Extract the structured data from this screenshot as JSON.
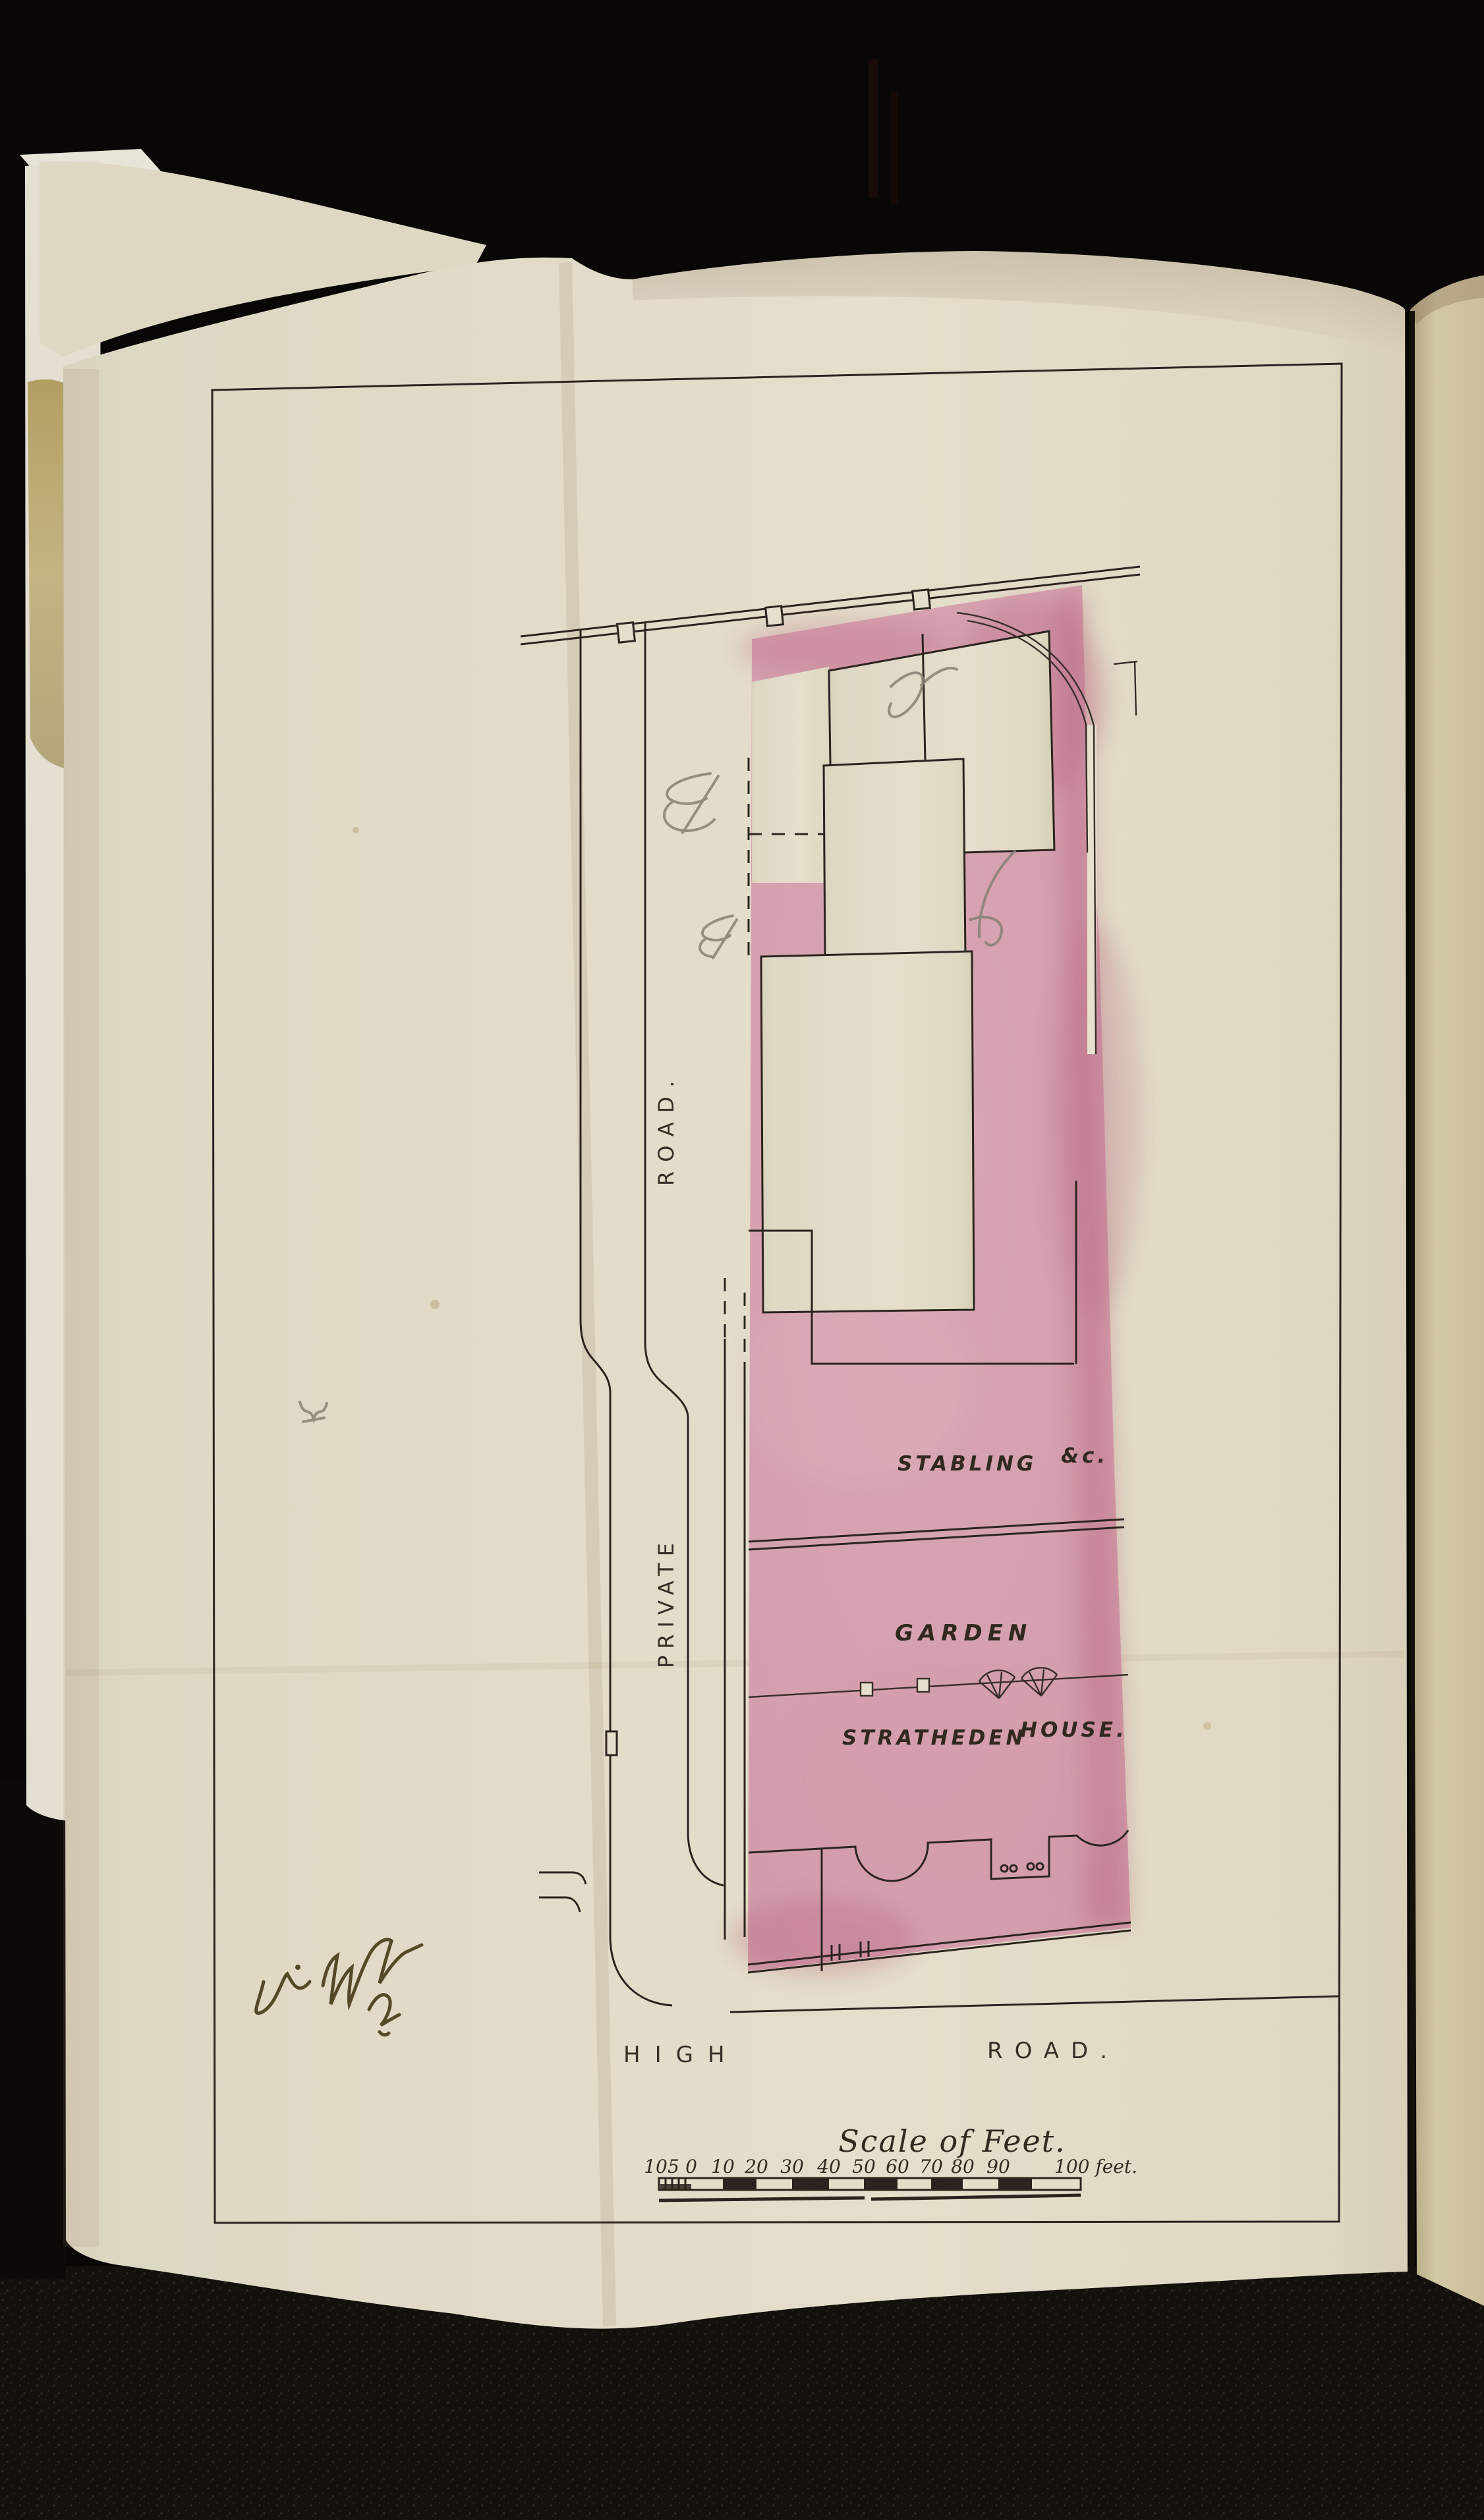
{
  "plan": {
    "labels": {
      "stabling": {
        "name": "STABLING",
        "suffix": "&c."
      },
      "garden": "GARDEN",
      "house": {
        "name": "STRATHEDEN",
        "suffix": "HOUSE."
      },
      "private_road_vertical": {
        "upper": "ROAD.",
        "lower": "PRIVATE"
      },
      "high_road": {
        "left": "HIGH",
        "right": "ROAD."
      }
    },
    "scale": {
      "title": "Scale of Feet.",
      "ticks": [
        "10",
        "5",
        "0",
        "10",
        "20",
        "30",
        "40",
        "50",
        "60",
        "70",
        "80",
        "90"
      ],
      "end_label": "100 feet."
    },
    "colors": {
      "plot_wash_pink": "#dca6b4",
      "plot_wash_deep": "#b85e7c",
      "paper_cream": "#e8e2cd",
      "underpage_tan": "#d9cead",
      "ink": "#2e2620",
      "pencil_grey": "#8b8577",
      "signature_ink": "#4a3e1c",
      "background_black": "#0a0806"
    }
  }
}
